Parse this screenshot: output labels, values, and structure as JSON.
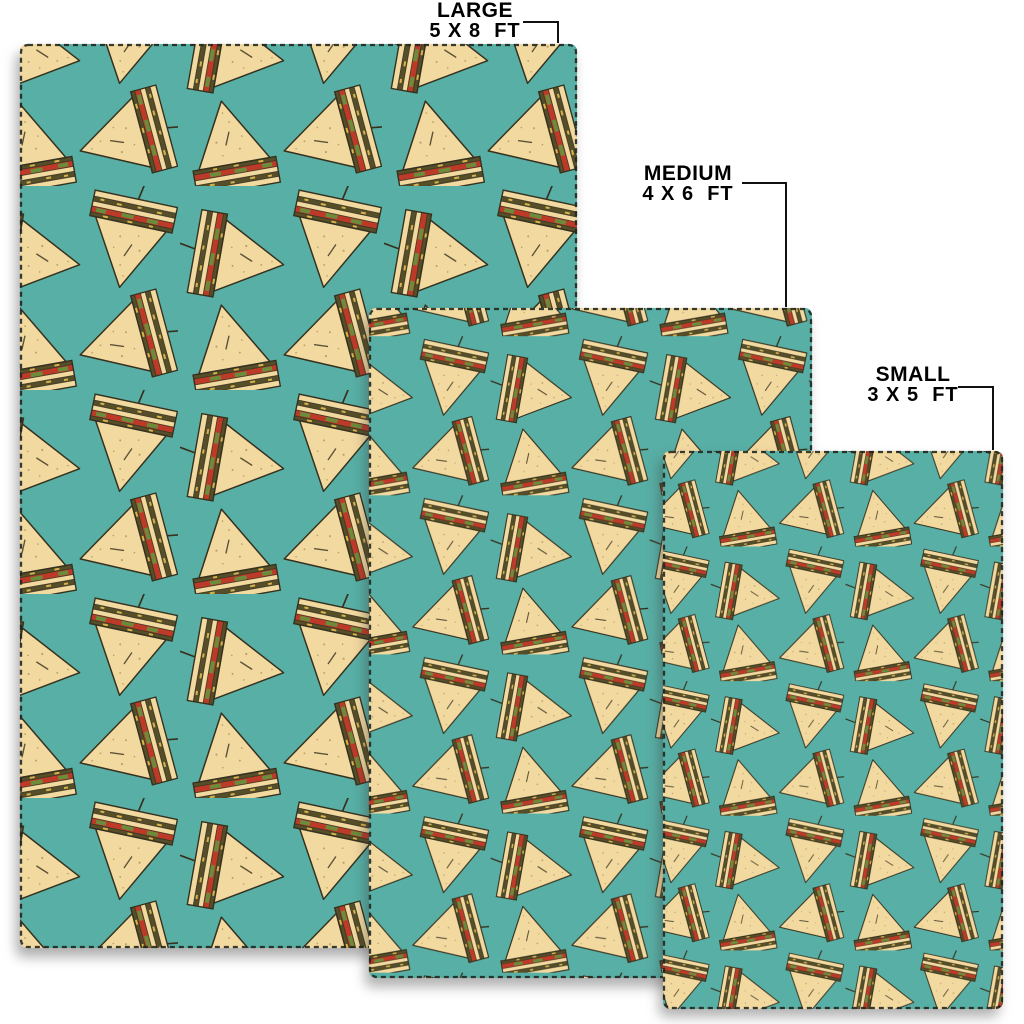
{
  "page": {
    "background": "#FFFFFF"
  },
  "product": {
    "pattern_motif": "club-sandwich-triangles",
    "colors": {
      "page_background": "#FFFFFF",
      "rug_background": "#58AFA5",
      "bread": "#F2D9A0",
      "crumb": "#8A6D3B",
      "outline": "#36311E",
      "lettuce": "#6B8C3A",
      "tomato": "#BE3A28",
      "seed_stripe": "#554E28",
      "cheese": "#D8B34A",
      "stitch": "#22271F",
      "leader_line": "#111111",
      "label_text": "#000000"
    },
    "sizes": [
      {
        "id": "large",
        "label": "LARGE",
        "dimensions": "5 X 8  FT"
      },
      {
        "id": "medium",
        "label": "MEDIUM",
        "dimensions": "4 X 6  FT"
      },
      {
        "id": "small",
        "label": "SMALL",
        "dimensions": "3 X 5  FT"
      }
    ]
  }
}
